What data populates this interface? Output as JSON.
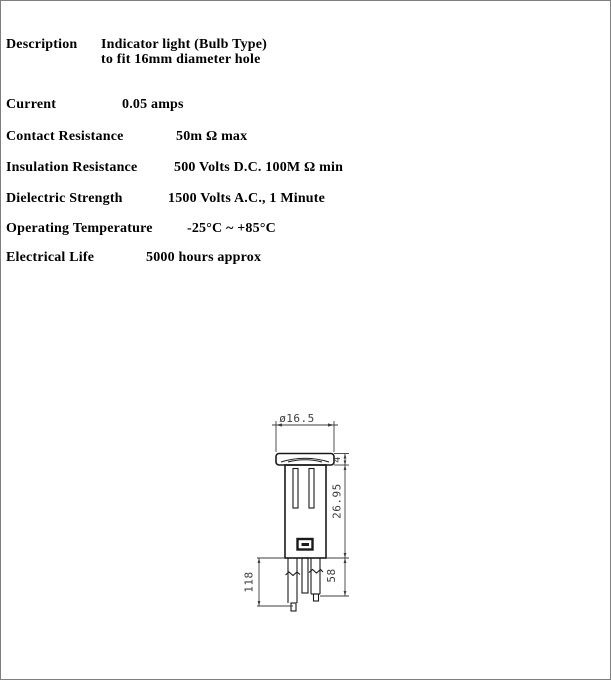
{
  "page": {
    "background": "#ffffff",
    "border_color": "#7f7f7f"
  },
  "specs": {
    "rows": [
      {
        "label": "Description",
        "value": "Indicator light (Bulb Type)",
        "value_line2": "to fit 16mm diameter hole"
      },
      {
        "label": "Current",
        "value": "0.05 amps"
      },
      {
        "label": "Contact Resistance",
        "value": "50m Ω max"
      },
      {
        "label": "Insulation Resistance",
        "value": "500 Volts D.C. 100M Ω min"
      },
      {
        "label": "Dielectric Strength",
        "value": "1500 Volts A.C., 1 Minute"
      },
      {
        "label": "Operating Temperature",
        "value": "-25°C  ~  +85°C"
      },
      {
        "label": "Electrical Life",
        "value": "5000 hours approx"
      }
    ]
  },
  "drawing": {
    "description": "dimensioned outline drawing of indicator light, front view",
    "line_color": "#1a1a1a",
    "dimension_color": "#3d3d3d",
    "dimensions": {
      "cap_diameter": "ø16.5",
      "cap_height": "4",
      "body_length": "26.95",
      "left_pin_length": "118",
      "right_pin_length": "58"
    }
  }
}
